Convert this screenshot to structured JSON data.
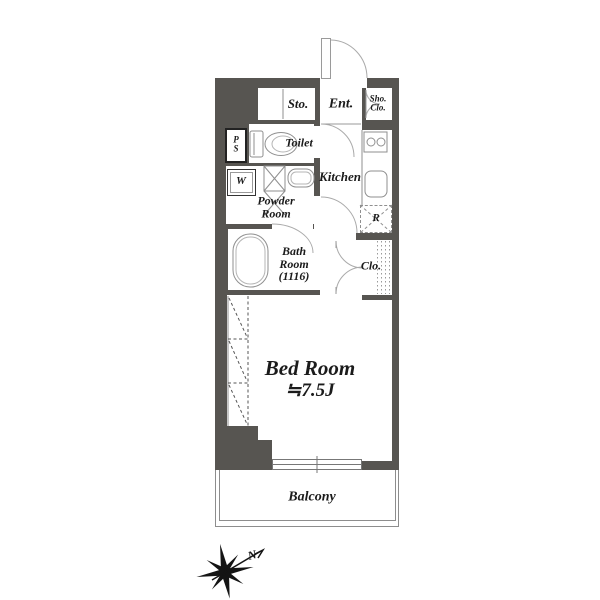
{
  "floorplan": {
    "rooms": {
      "storage": "Sto.",
      "entrance": "Ent.",
      "shoe_closet_line1": "Sho.",
      "shoe_closet_line2": "Clo.",
      "pipe_space_line1": "P",
      "pipe_space_line2": "S",
      "toilet": "Toilet",
      "washer": "W",
      "kitchen": "Kitchen",
      "powder_line1": "Powder",
      "powder_line2": "Room",
      "refrigerator": "R",
      "bath_line1": "Bath",
      "bath_line2": "Room",
      "bath_line3": "(1116)",
      "closet": "Clo.",
      "bedroom_name": "Bed Room",
      "bedroom_size": "≒7.5J",
      "balcony": "Balcony"
    },
    "compass": {
      "north_label": "N"
    },
    "colors": {
      "wall": "#575551",
      "fixture_line": "#8f8f8f",
      "door_arc": "#aaaaaa",
      "text": "#1b1b1b",
      "background": "#ffffff"
    }
  }
}
